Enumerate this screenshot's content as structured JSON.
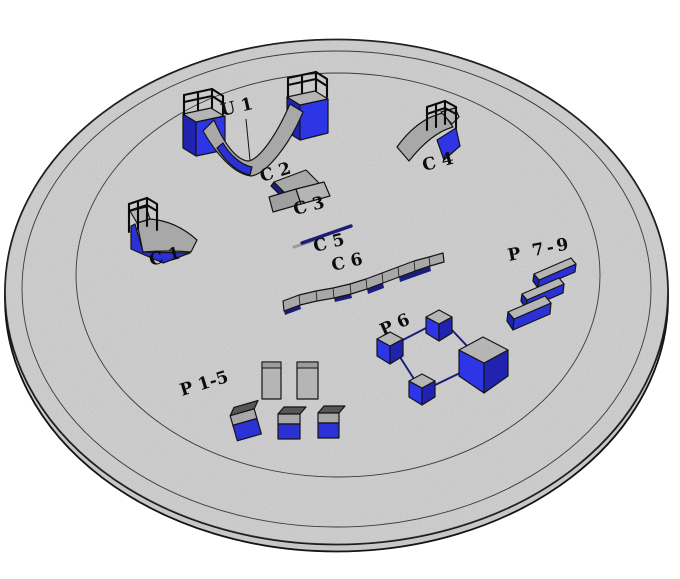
{
  "scene": {
    "labels": {
      "u1": "U 1",
      "c1": "C 1",
      "c2": "C 2",
      "c3": "C 3",
      "c4": "C 4",
      "c5": "C 5",
      "c6": "C 6",
      "p1_5": "P 1-5",
      "p6": "P 6",
      "p7_9": "P 7-9"
    },
    "colors": {
      "background": "#ffffff",
      "platform-fill": "#d6d6d6",
      "platform-rim": "#c7c7c7",
      "ring-line": "#3a3a3a",
      "outline": "#141414",
      "ramp-gray": "#a8a8a8",
      "deck-gray": "#b5b5b5",
      "dark-top-gray": "#565656",
      "obstacle-blue": "#2e35e6",
      "obstacle-blue-mid": "#2c31d6",
      "obstacle-blue-dark": "#1f23b0",
      "rail-navy": "#1b1d78",
      "label-ink": "#0c0c0c"
    }
  }
}
